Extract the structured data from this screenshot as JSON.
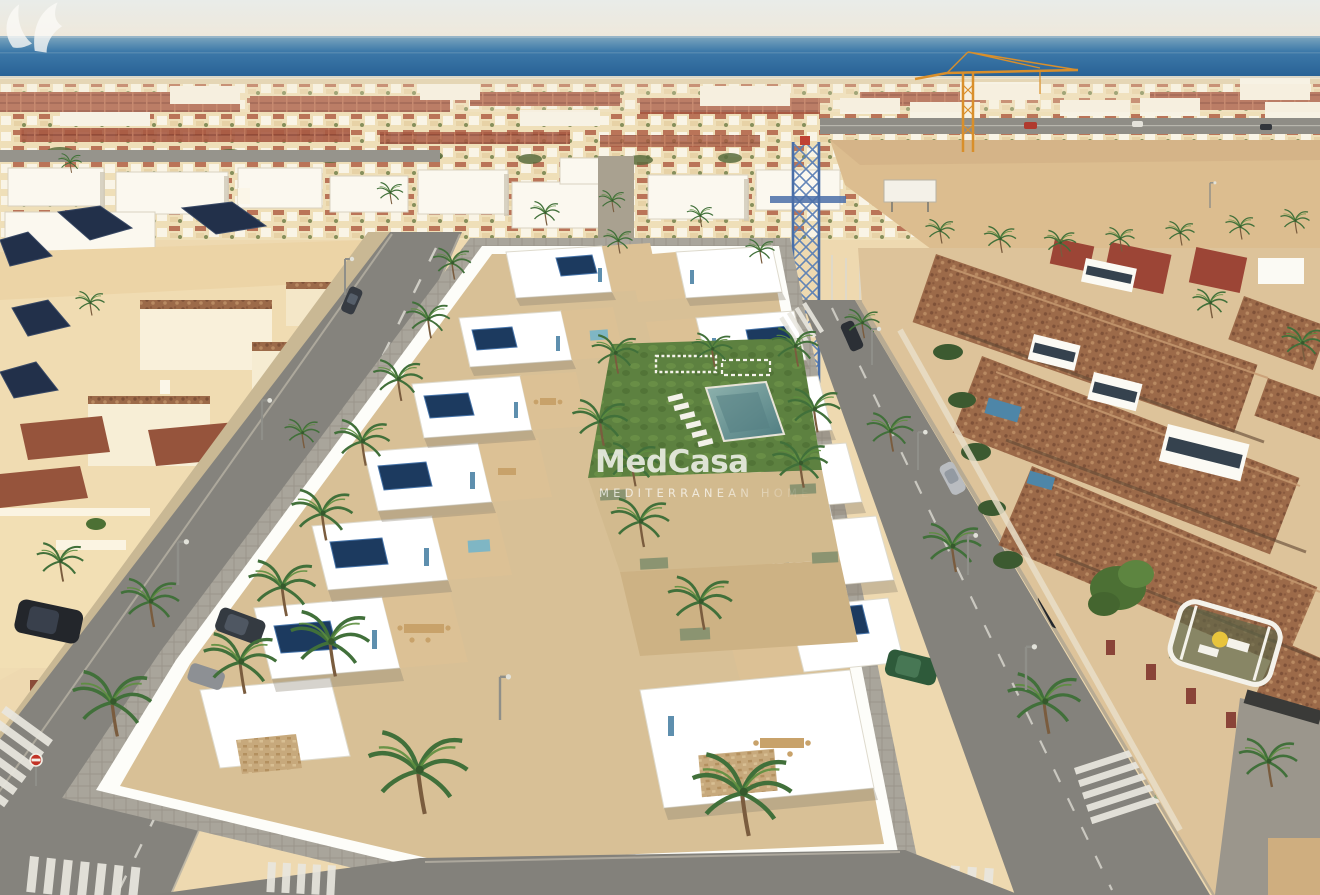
{
  "watermark": {
    "brand": "MedCasa",
    "tagline": "MEDITERRANEAN HOMES"
  },
  "palette": {
    "sky_top": "#e8ebe8",
    "sky_warm": "#efe8da",
    "sea_light": "#7fa7bf",
    "sea_deep": "#2a6ba0",
    "sand": "#e5d6b5",
    "dirt_lot": "#dcbd8f",
    "town_base": "#eed9b0",
    "town_white": "#f8f3e7",
    "roof_red": "#a85a43",
    "roof_navy": "#22304a",
    "roof_tile": "#9c6a49",
    "villa_white": "#fdfdf9",
    "terrace_tan": "#dcc195",
    "asphalt": "#86847e",
    "paver_grey": "#a9a59b",
    "paver_pink": "#c8a98a",
    "lawn_green": "#5d8140",
    "palm_green": "#3f6b34",
    "pool_teal": "#6b9898",
    "solar_navy": "#1c3a5f",
    "accent_blue": "#5e8fae",
    "stone_tan": "#c7a97c",
    "watermark_white": "#fbfaf6"
  }
}
